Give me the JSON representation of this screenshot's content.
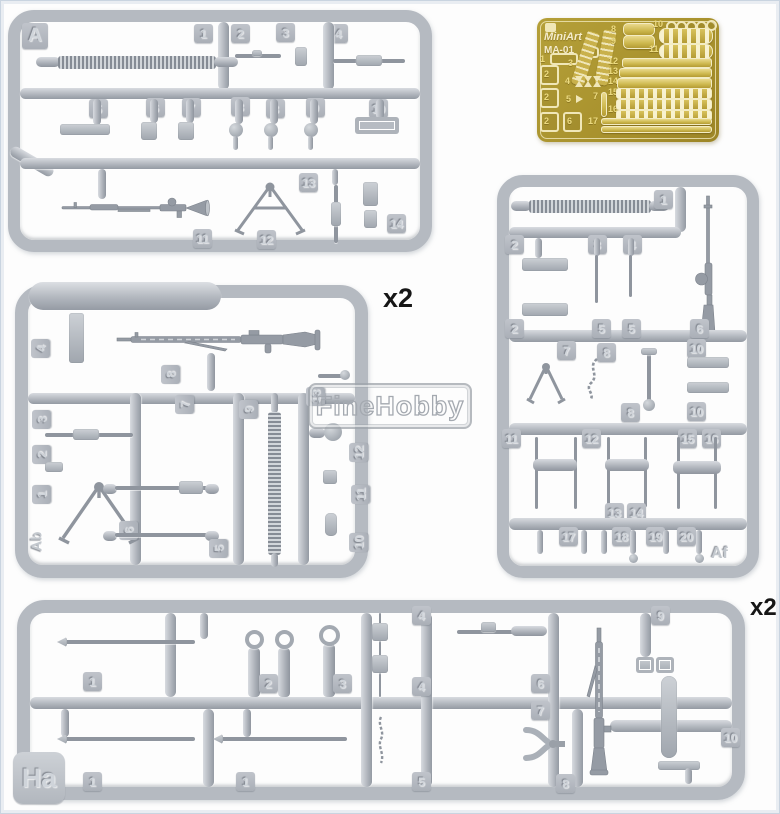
{
  "image": {
    "description": "Product photo of MiniArt 1/35 scale model kit: four grey styrene sprues with machine-gun parts and one brass photo-etched fret",
    "background": "#fdfdfd",
    "border_color": "#c9d4e0"
  },
  "colors": {
    "plastic": "#b5bac1",
    "plastic_dark": "#8f959e",
    "brass": "#a68f2b",
    "brass_light": "#ead98c",
    "cream": "#f0e7b8"
  },
  "watermark": {
    "text": "FineHobby"
  },
  "pe_fret": {
    "brand": "MiniArt",
    "code": "MA-01",
    "numbers": [
      "1",
      "2",
      "2",
      "2",
      "6",
      "3",
      "4",
      "5",
      "7",
      "8",
      "9",
      "10",
      "11",
      "12",
      "13",
      "14",
      "15",
      "16",
      "17"
    ]
  },
  "sprue_a": {
    "letter": "A",
    "tags": [
      "1",
      "2",
      "3",
      "4",
      "5",
      "6",
      "7",
      "8",
      "8",
      "9",
      "10",
      "11",
      "12",
      "13",
      "14"
    ]
  },
  "sprue_ab": {
    "letter": "Ab",
    "quantity": "x2",
    "tags": [
      "4",
      "8",
      "7",
      "3",
      "2",
      "1",
      "6",
      "5",
      "9",
      "13",
      "12",
      "11",
      "10"
    ]
  },
  "sprue_af": {
    "letter": "Af",
    "tags": [
      "1",
      "2",
      "3",
      "4",
      "2",
      "5",
      "5",
      "6",
      "7",
      "8",
      "10",
      "8",
      "10",
      "11",
      "12",
      "15",
      "16",
      "13",
      "14",
      "17",
      "18",
      "19",
      "20"
    ]
  },
  "sprue_ha": {
    "letter": "Ha",
    "quantity": "x2",
    "tags": [
      "1",
      "2",
      "3",
      "4",
      "4",
      "6",
      "9",
      "1",
      "1",
      "5",
      "7",
      "8",
      "10"
    ]
  }
}
